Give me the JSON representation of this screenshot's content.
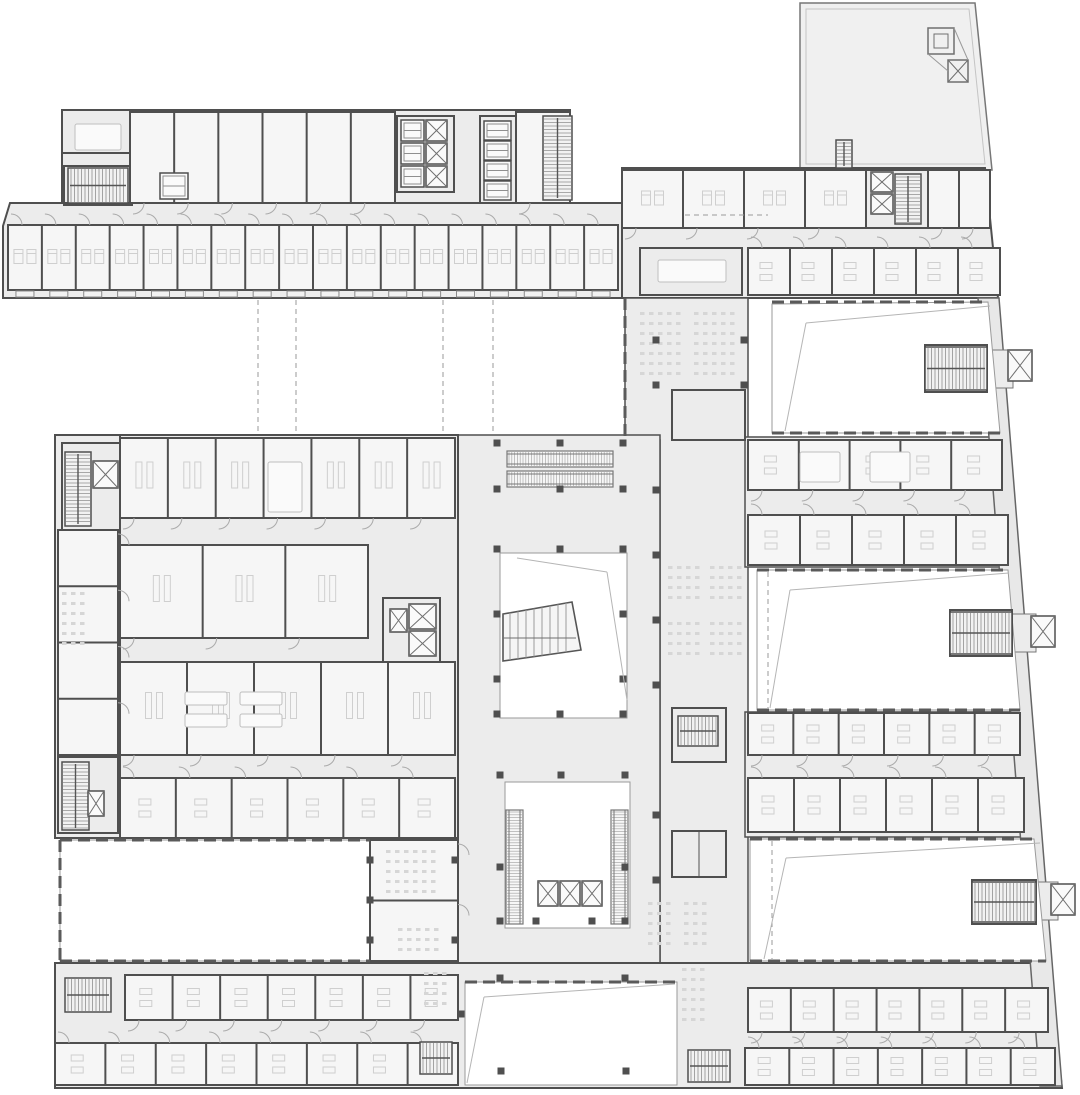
{
  "meta": {
    "title": "architectural-floor-plan",
    "description": "building-floor-plan-drawing",
    "visible_text": []
  },
  "colors": {
    "background": "#ffffff",
    "floor": "#ececec",
    "floor_light": "#f0f0f0",
    "room": "#f6f6f6",
    "wall": "#4f4f4f",
    "wall_light": "#9a9a9a",
    "detail": "#c9c9c9",
    "furniture": "#cfcfcf",
    "void_stroke": "#9a9a9a",
    "diagonal": "#b5b5b5",
    "column": "#4f4f4f",
    "stair_fill": "#f2f2f2",
    "hatch": "#8f8f8f"
  },
  "plan": {
    "bands": [
      {
        "x": 8,
        "y": 225,
        "w": 610,
        "h": 65,
        "n": 18,
        "door": "t",
        "furn": "bed",
        "name": "guest-room-band-northwest"
      },
      {
        "x": 130,
        "y": 112,
        "w": 265,
        "h": 91,
        "n": 6,
        "door": "b",
        "furn": "none",
        "name": "north-wing-upper-rooms"
      },
      {
        "x": 516,
        "y": 112,
        "w": 54,
        "h": 91,
        "n": 1,
        "door": "b",
        "furn": "none",
        "name": "north-wing-upper-east-room"
      },
      {
        "x": 622,
        "y": 170,
        "w": 244,
        "h": 58,
        "n": 4,
        "door": "b",
        "furn": "bed",
        "name": "northeast-wing-upper-rooms"
      },
      {
        "x": 928,
        "y": 170,
        "w": 62,
        "h": 58,
        "n": 2,
        "door": "b",
        "furn": "none",
        "name": "northeast-wing-corner-rooms"
      },
      {
        "x": 748,
        "y": 248,
        "w": 252,
        "h": 47,
        "n": 6,
        "door": "t",
        "furn": "desk",
        "name": "northeast-wing-office-row"
      },
      {
        "x": 120,
        "y": 438,
        "w": 335,
        "h": 80,
        "n": 7,
        "door": "b",
        "furn": "lab",
        "name": "west-block-row-1"
      },
      {
        "x": 120,
        "y": 545,
        "w": 248,
        "h": 93,
        "n": 3,
        "door": "b",
        "furn": "lab",
        "name": "west-block-row-2"
      },
      {
        "x": 120,
        "y": 662,
        "w": 335,
        "h": 93,
        "n": 5,
        "door": "b",
        "furn": "lab",
        "name": "west-block-row-3"
      },
      {
        "x": 120,
        "y": 778,
        "w": 335,
        "h": 60,
        "n": 6,
        "door": "t",
        "furn": "desk",
        "name": "west-block-row-4"
      },
      {
        "x": 748,
        "y": 440,
        "w": 254,
        "h": 50,
        "n": 5,
        "door": "b",
        "furn": "desk",
        "name": "east-wing-row-1"
      },
      {
        "x": 748,
        "y": 515,
        "w": 260,
        "h": 50,
        "n": 5,
        "door": "t",
        "furn": "desk",
        "name": "east-wing-row-2"
      },
      {
        "x": 748,
        "y": 713,
        "w": 272,
        "h": 42,
        "n": 6,
        "door": "b",
        "furn": "desk",
        "name": "east-wing-row-3"
      },
      {
        "x": 748,
        "y": 778,
        "w": 276,
        "h": 54,
        "n": 6,
        "door": "t",
        "furn": "desk",
        "name": "east-wing-row-4"
      },
      {
        "x": 125,
        "y": 975,
        "w": 333,
        "h": 45,
        "n": 7,
        "door": "b",
        "furn": "desk",
        "name": "south-wing-row-1-west"
      },
      {
        "x": 55,
        "y": 1043,
        "w": 403,
        "h": 42,
        "n": 8,
        "door": "t",
        "furn": "desk",
        "name": "south-wing-row-2-west"
      },
      {
        "x": 748,
        "y": 988,
        "w": 300,
        "h": 44,
        "n": 7,
        "door": "b",
        "furn": "desk",
        "name": "south-wing-row-1-east"
      },
      {
        "x": 745,
        "y": 1048,
        "w": 310,
        "h": 37,
        "n": 7,
        "door": "t",
        "furn": "desk",
        "name": "south-wing-row-2-east"
      },
      {
        "x": 58,
        "y": 530,
        "w": 60,
        "h": 225,
        "n": 4,
        "door": "r",
        "furn": "none",
        "name": "west-block-edge-rooms"
      },
      {
        "x": 370,
        "y": 840,
        "w": 88,
        "h": 121,
        "n": 2,
        "door": "r",
        "furn": "none",
        "name": "classroom-block"
      }
    ],
    "stairs": [
      {
        "x": 68,
        "y": 168,
        "w": 60,
        "h": 35,
        "o": "h",
        "name": "stair-northwest-core"
      },
      {
        "x": 543,
        "y": 116,
        "w": 29,
        "h": 84,
        "o": "v",
        "name": "stair-north-wing-east"
      },
      {
        "x": 836,
        "y": 140,
        "w": 16,
        "h": 28,
        "o": "v",
        "name": "stair-terrace"
      },
      {
        "x": 895,
        "y": 174,
        "w": 26,
        "h": 50,
        "o": "v",
        "name": "stair-northeast-core"
      },
      {
        "x": 65,
        "y": 452,
        "w": 26,
        "h": 74,
        "o": "v",
        "name": "stair-west-block-north"
      },
      {
        "x": 62,
        "y": 762,
        "w": 27,
        "h": 68,
        "o": "v",
        "name": "stair-west-block-south"
      },
      {
        "x": 925,
        "y": 347,
        "w": 62,
        "h": 43,
        "o": "h",
        "name": "stair-east-pod-1"
      },
      {
        "x": 950,
        "y": 612,
        "w": 62,
        "h": 42,
        "o": "h",
        "name": "stair-east-pod-2"
      },
      {
        "x": 972,
        "y": 882,
        "w": 64,
        "h": 40,
        "o": "h",
        "name": "stair-east-pod-3"
      },
      {
        "x": 65,
        "y": 978,
        "w": 46,
        "h": 34,
        "o": "h",
        "name": "stair-south-wing-west"
      },
      {
        "x": 420,
        "y": 1042,
        "w": 32,
        "h": 32,
        "o": "h",
        "name": "stair-south-center"
      },
      {
        "x": 688,
        "y": 1050,
        "w": 42,
        "h": 32,
        "o": "h",
        "name": "stair-south-wing-east"
      },
      {
        "x": 678,
        "y": 716,
        "w": 40,
        "h": 30,
        "o": "h",
        "name": "stair-spine"
      }
    ],
    "elevators": [
      {
        "x": 401,
        "y": 120,
        "w": 23,
        "h": 21,
        "s": "car"
      },
      {
        "x": 401,
        "y": 143,
        "w": 23,
        "h": 21,
        "s": "car"
      },
      {
        "x": 401,
        "y": 166,
        "w": 23,
        "h": 21,
        "s": "car"
      },
      {
        "x": 426,
        "y": 120,
        "w": 21,
        "h": 21,
        "s": "x"
      },
      {
        "x": 426,
        "y": 143,
        "w": 21,
        "h": 21,
        "s": "x"
      },
      {
        "x": 426,
        "y": 166,
        "w": 21,
        "h": 21,
        "s": "x"
      },
      {
        "x": 484,
        "y": 121,
        "w": 27,
        "h": 19,
        "s": "car"
      },
      {
        "x": 484,
        "y": 141,
        "w": 27,
        "h": 19,
        "s": "car"
      },
      {
        "x": 484,
        "y": 161,
        "w": 27,
        "h": 19,
        "s": "car"
      },
      {
        "x": 484,
        "y": 181,
        "w": 27,
        "h": 19,
        "s": "car"
      },
      {
        "x": 160,
        "y": 173,
        "w": 28,
        "h": 26,
        "s": "car"
      },
      {
        "x": 871,
        "y": 172,
        "w": 22,
        "h": 20,
        "s": "x"
      },
      {
        "x": 871,
        "y": 194,
        "w": 22,
        "h": 20,
        "s": "x"
      },
      {
        "x": 93,
        "y": 461,
        "w": 25,
        "h": 27,
        "s": "x"
      },
      {
        "x": 390,
        "y": 609,
        "w": 17,
        "h": 23,
        "s": "x"
      },
      {
        "x": 409,
        "y": 604,
        "w": 27,
        "h": 25,
        "s": "x"
      },
      {
        "x": 409,
        "y": 631,
        "w": 27,
        "h": 25,
        "s": "x"
      },
      {
        "x": 88,
        "y": 791,
        "w": 16,
        "h": 25,
        "s": "x"
      },
      {
        "x": 538,
        "y": 881,
        "w": 20,
        "h": 25,
        "s": "x"
      },
      {
        "x": 560,
        "y": 881,
        "w": 20,
        "h": 25,
        "s": "x"
      },
      {
        "x": 582,
        "y": 881,
        "w": 20,
        "h": 25,
        "s": "x"
      },
      {
        "x": 1008,
        "y": 350,
        "w": 24,
        "h": 31,
        "s": "x"
      },
      {
        "x": 1031,
        "y": 616,
        "w": 24,
        "h": 31,
        "s": "x"
      },
      {
        "x": 1051,
        "y": 884,
        "w": 24,
        "h": 31,
        "s": "x"
      }
    ],
    "escalators": [
      {
        "x": 507,
        "y": 451,
        "w": 106,
        "h": 16,
        "o": "h"
      },
      {
        "x": 507,
        "y": 471,
        "w": 106,
        "h": 16,
        "o": "h"
      },
      {
        "x": 506,
        "y": 810,
        "w": 17,
        "h": 114,
        "o": "v"
      },
      {
        "x": 611,
        "y": 810,
        "w": 17,
        "h": 114,
        "o": "v"
      }
    ],
    "seats": [
      {
        "x": 640,
        "y": 312,
        "r": 7,
        "c": 5
      },
      {
        "x": 694,
        "y": 312,
        "r": 7,
        "c": 5
      },
      {
        "x": 668,
        "y": 566,
        "r": 4,
        "c": 4
      },
      {
        "x": 710,
        "y": 566,
        "r": 4,
        "c": 4
      },
      {
        "x": 668,
        "y": 622,
        "r": 4,
        "c": 4
      },
      {
        "x": 710,
        "y": 622,
        "r": 4,
        "c": 4
      },
      {
        "x": 648,
        "y": 902,
        "r": 5,
        "c": 3
      },
      {
        "x": 684,
        "y": 902,
        "r": 5,
        "c": 3
      },
      {
        "x": 682,
        "y": 968,
        "r": 6,
        "c": 3
      },
      {
        "x": 62,
        "y": 592,
        "r": 6,
        "c": 3
      },
      {
        "x": 386,
        "y": 850,
        "r": 5,
        "c": 6
      },
      {
        "x": 398,
        "y": 928,
        "r": 3,
        "c": 5
      },
      {
        "x": 424,
        "y": 972,
        "r": 4,
        "c": 3
      }
    ],
    "tables": [
      {
        "x": 75,
        "y": 124,
        "w": 46,
        "h": 26
      },
      {
        "x": 658,
        "y": 260,
        "w": 68,
        "h": 22
      },
      {
        "x": 268,
        "y": 462,
        "w": 34,
        "h": 50
      },
      {
        "x": 185,
        "y": 692,
        "w": 42,
        "h": 13
      },
      {
        "x": 240,
        "y": 692,
        "w": 42,
        "h": 13
      },
      {
        "x": 185,
        "y": 714,
        "w": 42,
        "h": 13
      },
      {
        "x": 240,
        "y": 714,
        "w": 42,
        "h": 13
      },
      {
        "x": 800,
        "y": 452,
        "w": 40,
        "h": 30
      },
      {
        "x": 870,
        "y": 452,
        "w": 40,
        "h": 30
      }
    ],
    "columns": [
      [
        497,
        443
      ],
      [
        560,
        443
      ],
      [
        623,
        443
      ],
      [
        497,
        489
      ],
      [
        560,
        489
      ],
      [
        623,
        489
      ],
      [
        497,
        549
      ],
      [
        560,
        549
      ],
      [
        623,
        549
      ],
      [
        497,
        614
      ],
      [
        623,
        614
      ],
      [
        497,
        679
      ],
      [
        623,
        679
      ],
      [
        497,
        714
      ],
      [
        560,
        714
      ],
      [
        623,
        714
      ],
      [
        500,
        775
      ],
      [
        561,
        775
      ],
      [
        625,
        775
      ],
      [
        500,
        867
      ],
      [
        625,
        867
      ],
      [
        500,
        921
      ],
      [
        536,
        921
      ],
      [
        592,
        921
      ],
      [
        625,
        921
      ],
      [
        500,
        978
      ],
      [
        625,
        978
      ],
      [
        461,
        1014
      ],
      [
        501,
        1071
      ],
      [
        626,
        1071
      ],
      [
        656,
        340
      ],
      [
        656,
        385
      ],
      [
        656,
        490
      ],
      [
        656,
        555
      ],
      [
        656,
        620
      ],
      [
        656,
        685
      ],
      [
        656,
        815
      ],
      [
        656,
        880
      ],
      [
        744,
        340
      ],
      [
        744,
        385
      ],
      [
        370,
        860
      ],
      [
        370,
        900
      ],
      [
        370,
        940
      ],
      [
        455,
        860
      ],
      [
        455,
        940
      ]
    ],
    "dashes": [
      [
        258,
        300,
        258,
        433
      ],
      [
        296,
        300,
        296,
        433
      ],
      [
        443,
        300,
        443,
        435
      ],
      [
        493,
        300,
        493,
        435
      ],
      [
        768,
        572,
        768,
        708
      ],
      [
        772,
        841,
        772,
        959
      ],
      [
        685,
        215,
        768,
        215
      ]
    ],
    "toothed": [
      [
        772,
        302,
        988,
        302
      ],
      [
        772,
        433,
        1000,
        433
      ],
      [
        757,
        570,
        1008,
        570
      ],
      [
        757,
        710,
        1020,
        710
      ],
      [
        750,
        839,
        1034,
        839
      ],
      [
        750,
        961,
        1046,
        961
      ],
      [
        60,
        840,
        370,
        840
      ],
      [
        60,
        961,
        370,
        961
      ],
      [
        60,
        840,
        60,
        961
      ],
      [
        625,
        298,
        625,
        440
      ],
      [
        465,
        982,
        677,
        982
      ]
    ],
    "diagonals": [
      [
        785,
        431,
        806,
        323
      ],
      [
        806,
        323,
        990,
        306
      ],
      [
        770,
        708,
        790,
        590
      ],
      [
        790,
        590,
        1009,
        573
      ],
      [
        764,
        959,
        786,
        858
      ],
      [
        786,
        858,
        1040,
        843
      ],
      [
        517,
        558,
        607,
        572
      ],
      [
        607,
        572,
        627,
        700
      ],
      [
        484,
        997,
        675,
        984
      ],
      [
        484,
        997,
        467,
        1083
      ]
    ]
  }
}
